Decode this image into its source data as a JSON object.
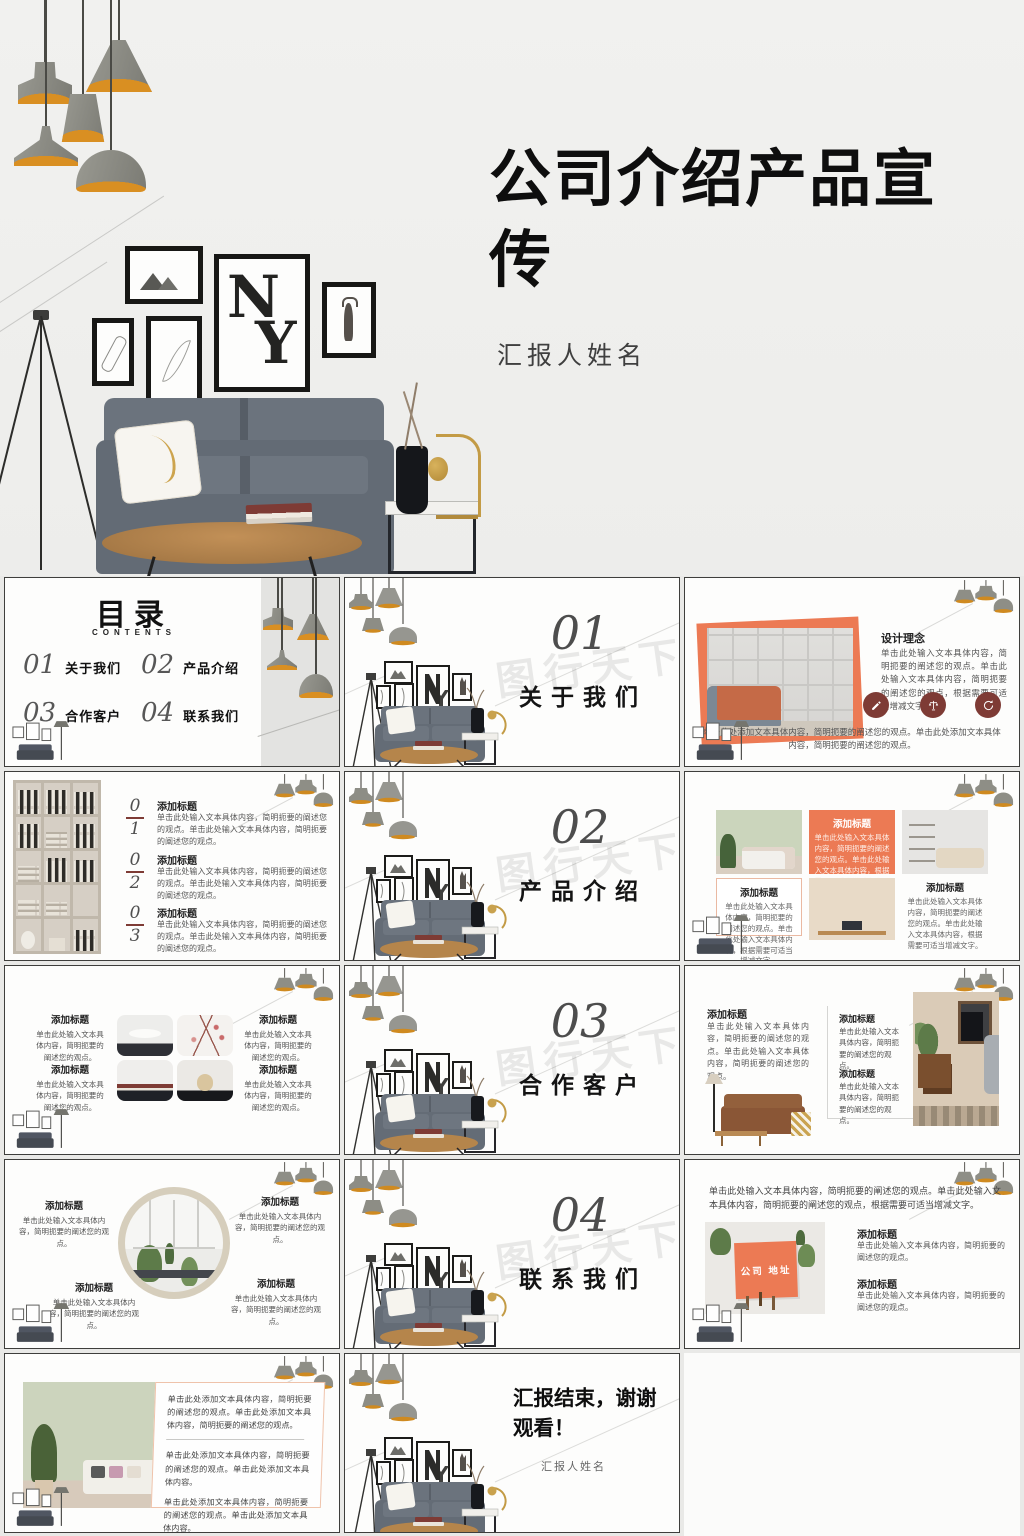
{
  "colors": {
    "accent": "#EC7A54",
    "maroon": "#7E3B35",
    "number_gray": "#4D4D4D",
    "lamp_glow": "#D98F22"
  },
  "watermark": "图行天下",
  "cover": {
    "title": "公司介绍产品宣传",
    "subtitle": "汇报人姓名",
    "poster_top": "N",
    "poster_bottom": "Y"
  },
  "toc": {
    "title": "目录",
    "subtitle": "CONTENTS",
    "items": [
      {
        "num": "01",
        "label": "关于我们"
      },
      {
        "num": "02",
        "label": "产品介绍"
      },
      {
        "num": "03",
        "label": "合作客户"
      },
      {
        "num": "04",
        "label": "联系我们"
      }
    ]
  },
  "sections": [
    {
      "num": "01",
      "title": "关于我们"
    },
    {
      "num": "02",
      "title": "产品介绍"
    },
    {
      "num": "03",
      "title": "合作客户"
    },
    {
      "num": "04",
      "title": "联系我们"
    }
  ],
  "slide_about": {
    "title": "设计理念",
    "body": "单击此处输入文本具体内容，简明扼要的阐述您的观点。单击此处输入文本具体内容，简明扼要的阐述您的观点，根据需要可适当增减文字。",
    "icons": [
      "pen-icon",
      "scales-icon",
      "refresh-icon"
    ],
    "caption": "单击此处添加文本具体内容，简明扼要的阐述您的观点。单击此处添加文本具体内容，简明扼要的阐述您的观点。"
  },
  "slide_numbers": {
    "items": [
      {
        "top": "0",
        "bottom": "1",
        "title": "添加标题",
        "body": "单击此处输入文本具体内容，简明扼要的阐述您的观点。单击此处输入文本具体内容，简明扼要的阐述您的观点。"
      },
      {
        "top": "0",
        "bottom": "2",
        "title": "添加标题",
        "body": "单击此处输入文本具体内容，简明扼要的阐述您的观点。单击此处输入文本具体内容，简明扼要的阐述您的观点。"
      },
      {
        "top": "0",
        "bottom": "3",
        "title": "添加标题",
        "body": "单击此处输入文本具体内容，简明扼要的阐述您的观点。单击此处输入文本具体内容，简明扼要的阐述您的观点。"
      }
    ]
  },
  "slide_products": {
    "left": {
      "title": "添加标题",
      "body": "单击此处输入文本具体内容，简明扼要的阐述您的观点。单击此处输入文本具体内容，根据需要可适当增减文字。"
    },
    "mid": {
      "title": "添加标题",
      "body": "单击此处输入文本具体内容，简明扼要的阐述您的观点。单击此处输入文本具体内容，根据需要可适当增减文字。"
    },
    "right": {
      "title": "添加标题",
      "body": "单击此处输入文本具体内容，简明扼要的阐述您的观点。单击此处输入文本具体内容，根据需要可适当增减文字。"
    }
  },
  "slide_grid": {
    "blocks": [
      {
        "title": "添加标题",
        "body": "单击此处输入文本具体内容，简明扼要的阐述您的观点。"
      },
      {
        "title": "添加标题",
        "body": "单击此处输入文本具体内容，简明扼要的阐述您的观点。"
      },
      {
        "title": "添加标题",
        "body": "单击此处输入文本具体内容，简明扼要的阐述您的观点。"
      },
      {
        "title": "添加标题",
        "body": "单击此处输入文本具体内容，简明扼要的阐述您的观点。"
      }
    ]
  },
  "slide_partners": {
    "left": {
      "title": "添加标题",
      "body": "单击此处输入文本具体内容，简明扼要的阐述您的观点。单击此处输入文本具体内容，简明扼要的阐述您的观点。"
    },
    "blocks": [
      {
        "title": "添加标题",
        "body": "单击此处输入文本具体内容，简明扼要的阐述您的观点。"
      },
      {
        "title": "添加标题",
        "body": "单击此处输入文本具体内容，简明扼要的阐述您的观点。"
      }
    ]
  },
  "slide_mirror": {
    "blocks": [
      {
        "title": "添加标题",
        "body": "单击此处输入文本具体内容，简明扼要的阐述您的观点。"
      },
      {
        "title": "添加标题",
        "body": "单击此处输入文本具体内容，简明扼要的阐述您的观点。"
      },
      {
        "title": "添加标题",
        "body": "单击此处输入文本具体内容，简明扼要的阐述您的观点。"
      },
      {
        "title": "添加标题",
        "body": "单击此处输入文本具体内容，简明扼要的阐述您的观点。"
      }
    ]
  },
  "slide_contact": {
    "intro": "单击此处输入文本具体内容，简明扼要的阐述您的观点。单击此处输入文本具体内容，简明扼要的阐述您的观点，根据需要可适当增减文字。",
    "board": "公司 地址",
    "blocks": [
      {
        "title": "添加标题",
        "body": "单击此处输入文本具体内容，简明扼要的阐述您的观点。"
      },
      {
        "title": "添加标题",
        "body": "单击此处输入文本具体内容，简明扼要的阐述您的观点。"
      }
    ]
  },
  "slide_summary": {
    "paras": [
      "单击此处添加文本具体内容，简明扼要的阐述您的观点。单击此处添加文本具体内容，简明扼要的阐述您的观点。",
      "单击此处添加文本具体内容，简明扼要的阐述您的观点。单击此处添加文本具体内容。",
      "单击此处添加文本具体内容，简明扼要的阐述您的观点。单击此处添加文本具体内容。"
    ]
  },
  "end": {
    "title": "汇报结束，谢谢观看！",
    "subtitle": "汇报人姓名"
  }
}
